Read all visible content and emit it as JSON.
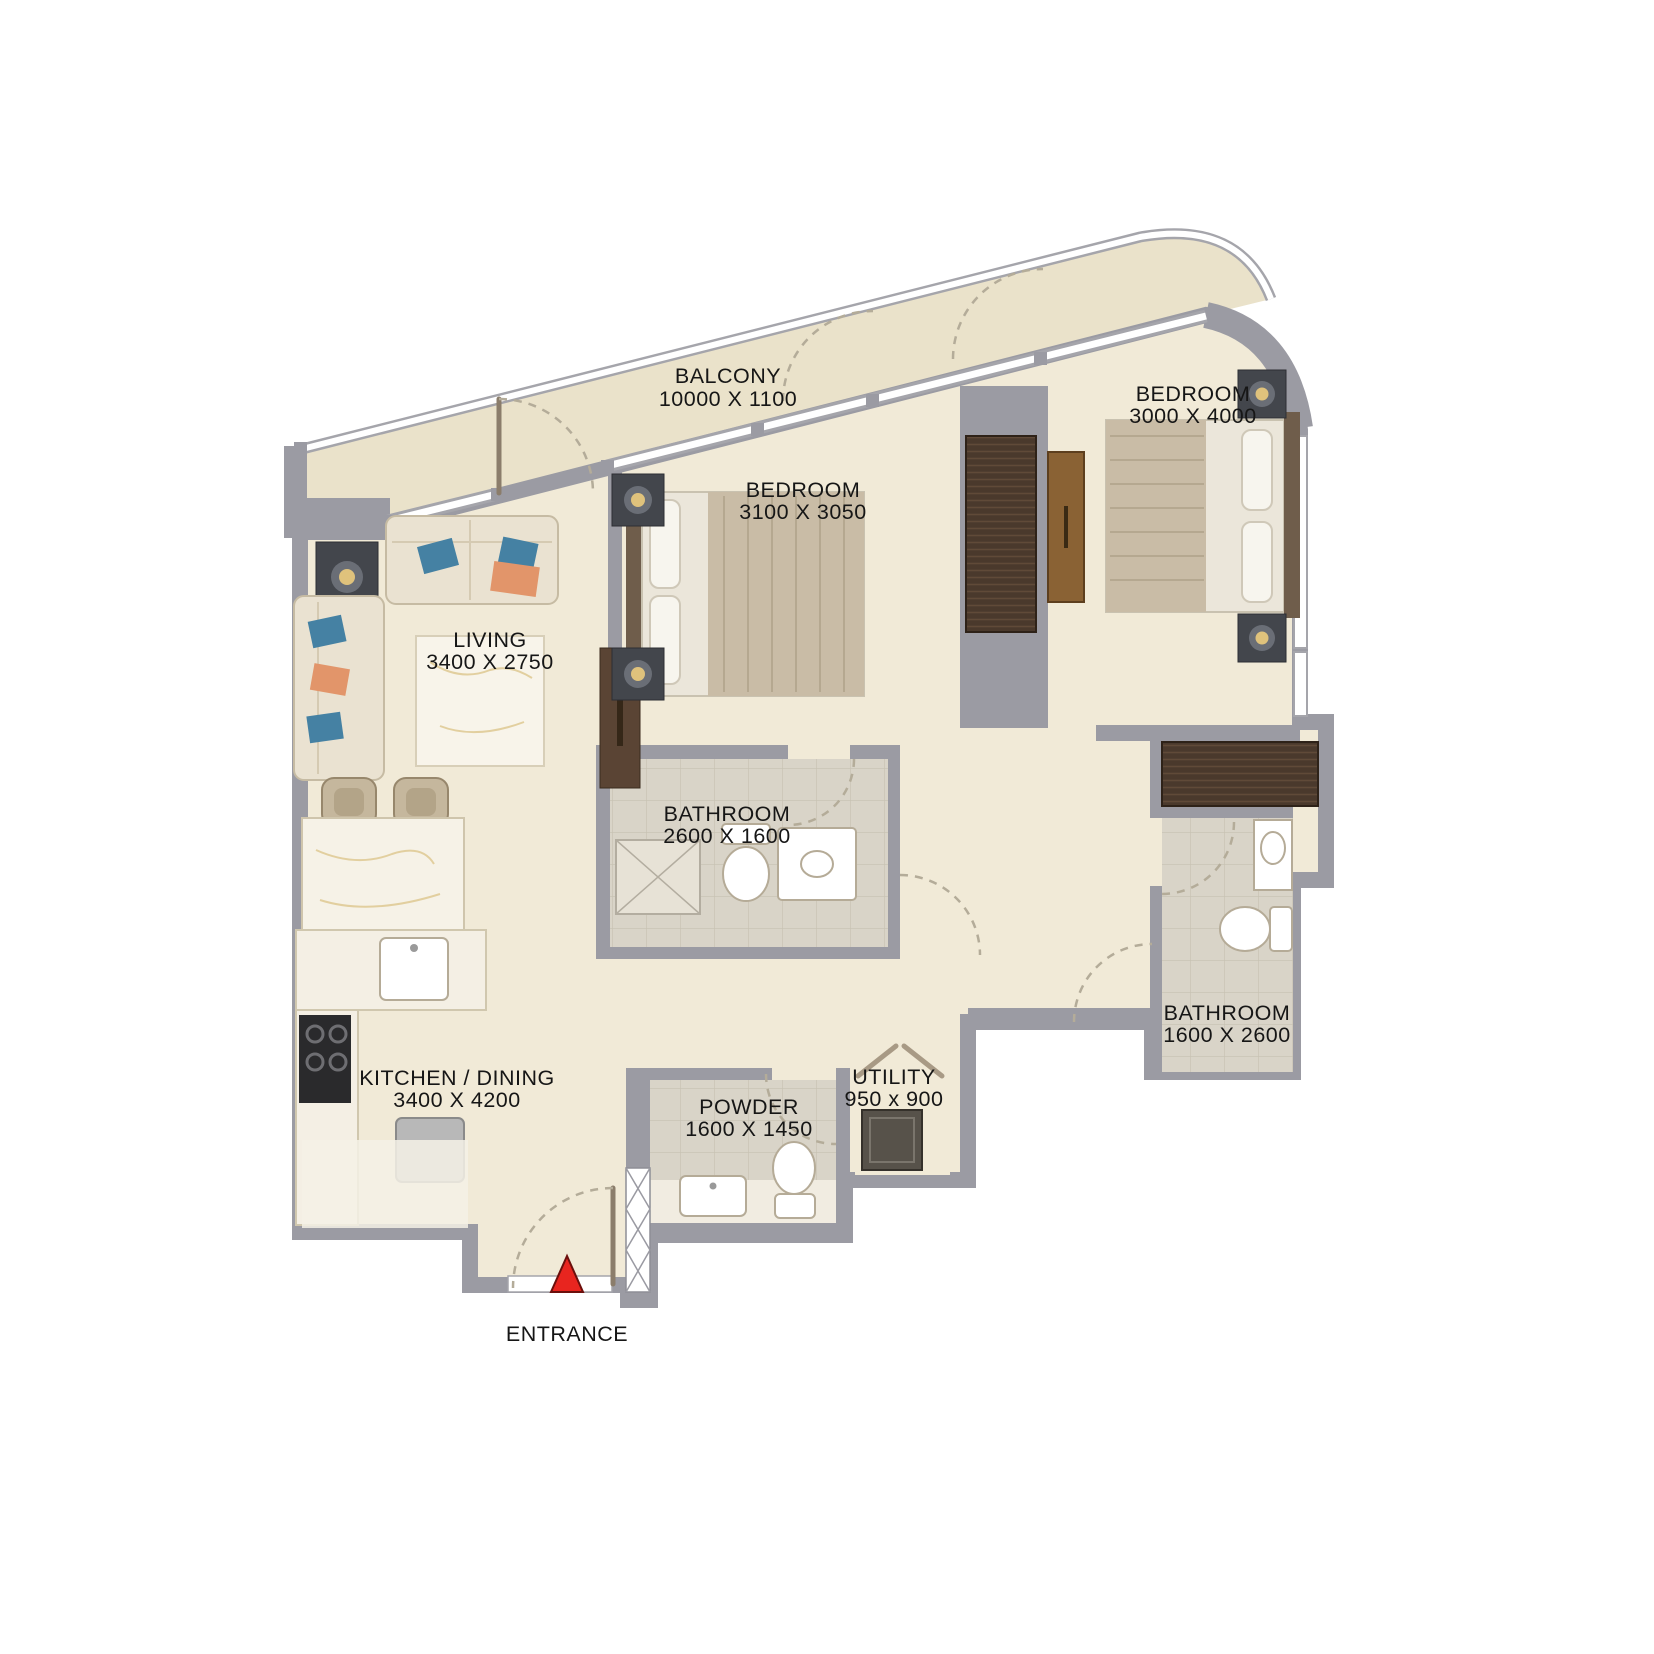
{
  "plan": {
    "rooms": [
      {
        "name": "BALCONY",
        "dims": "10000 X 1100"
      },
      {
        "name": "BEDROOM",
        "dims": "3000 X 4000"
      },
      {
        "name": "BEDROOM",
        "dims": "3100 X 3050"
      },
      {
        "name": "LIVING",
        "dims": "3400 X 2750"
      },
      {
        "name": "BATHROOM",
        "dims": "2600 X 1600"
      },
      {
        "name": "BATHROOM",
        "dims": "1600 X 2600"
      },
      {
        "name": "KITCHEN / DINING",
        "dims": "3400 X 4200"
      },
      {
        "name": "POWDER",
        "dims": "1600 X 1450"
      },
      {
        "name": "UTILITY",
        "dims": "950 x 900"
      }
    ],
    "entrance": {
      "label": "ENTRANCE"
    },
    "colors": {
      "wall": "#9b9ba3",
      "floor": "#f1ead7",
      "balcony_floor": "#eae2ca",
      "bath_floor": "#d9d4c8",
      "wardrobe_wood": "#4a392c",
      "dresser_wood": "#8a6234",
      "sofa_cream": "#eae2d1",
      "pillow_blue": "#4581a3",
      "pillow_orange": "#e2956a",
      "entrance_marker_red": "#e8251f"
    }
  }
}
